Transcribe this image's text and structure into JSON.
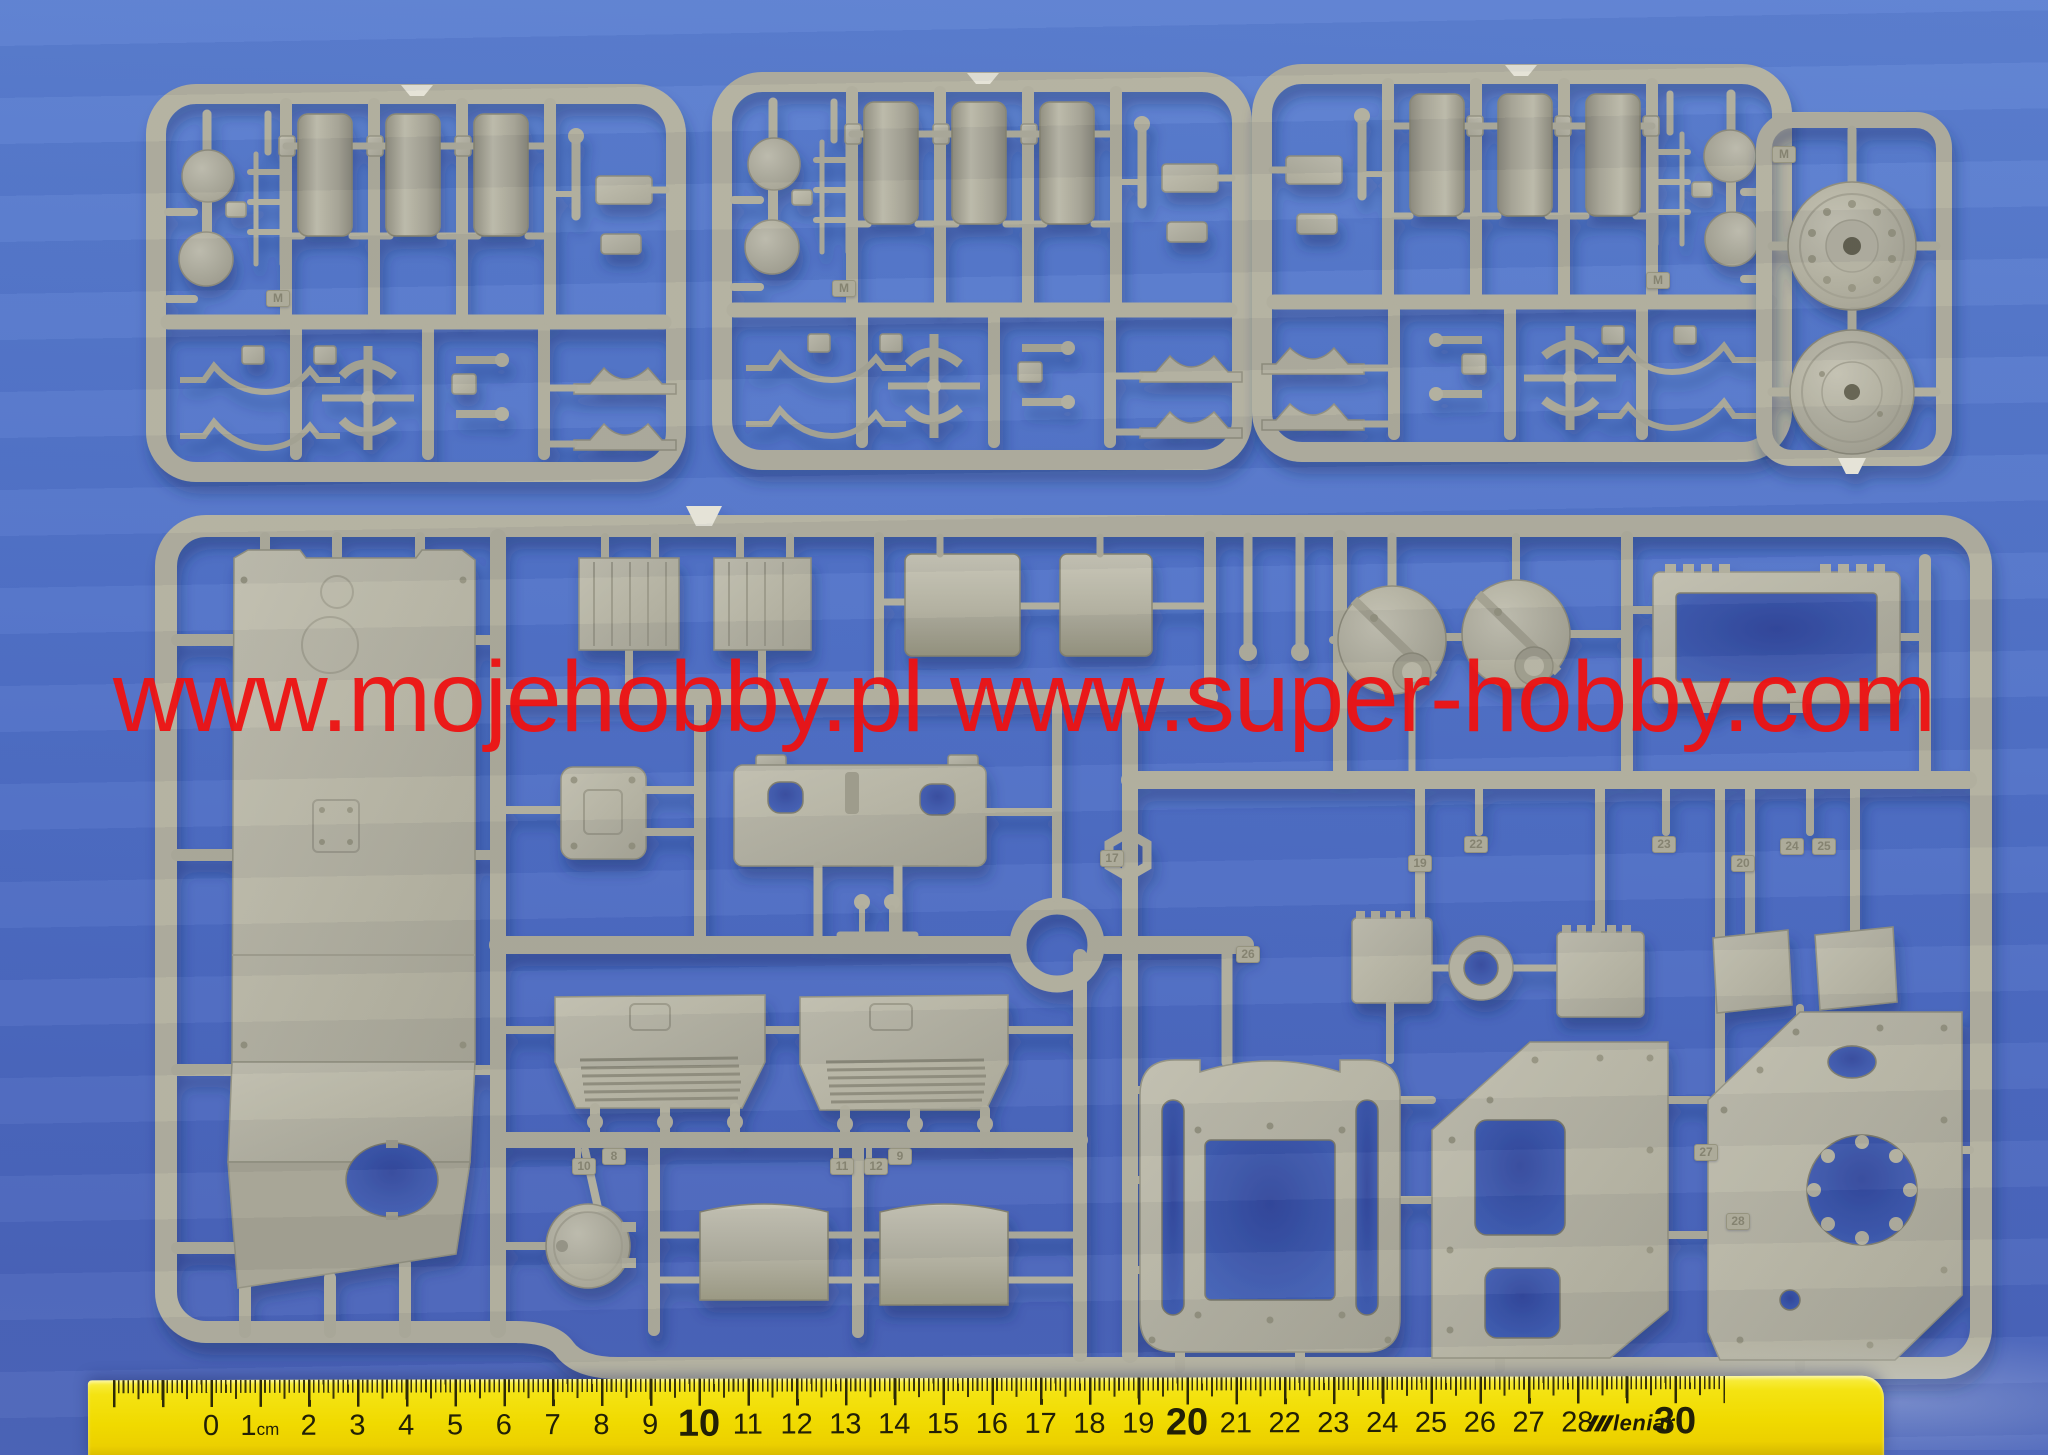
{
  "image": {
    "kind": "product photo",
    "subject": "Plastic model kit injection sprues (grey styrene) photographed on a blue background with a centimeter ruler"
  },
  "watermark": {
    "text": "www.mojehobby.pl www.super-hobby.com",
    "color": "#ee1212"
  },
  "ruler": {
    "brand": "leniar",
    "unit": "cm",
    "numbers": [
      {
        "cm": 0,
        "label": "0"
      },
      {
        "cm": 1,
        "label": "1",
        "suffix": "cm"
      },
      {
        "cm": 2,
        "label": "2"
      },
      {
        "cm": 3,
        "label": "3"
      },
      {
        "cm": 4,
        "label": "4"
      },
      {
        "cm": 5,
        "label": "5"
      },
      {
        "cm": 6,
        "label": "6"
      },
      {
        "cm": 7,
        "label": "7"
      },
      {
        "cm": 8,
        "label": "8"
      },
      {
        "cm": 9,
        "label": "9"
      },
      {
        "cm": 10,
        "label": "10",
        "big": true
      },
      {
        "cm": 11,
        "label": "11"
      },
      {
        "cm": 12,
        "label": "12"
      },
      {
        "cm": 13,
        "label": "13"
      },
      {
        "cm": 14,
        "label": "14"
      },
      {
        "cm": 15,
        "label": "15"
      },
      {
        "cm": 16,
        "label": "16"
      },
      {
        "cm": 17,
        "label": "17"
      },
      {
        "cm": 18,
        "label": "18"
      },
      {
        "cm": 19,
        "label": "19"
      },
      {
        "cm": 20,
        "label": "20",
        "big": true
      },
      {
        "cm": 21,
        "label": "21"
      },
      {
        "cm": 22,
        "label": "22"
      },
      {
        "cm": 23,
        "label": "23"
      },
      {
        "cm": 24,
        "label": "24"
      },
      {
        "cm": 25,
        "label": "25"
      },
      {
        "cm": 26,
        "label": "26"
      },
      {
        "cm": 27,
        "label": "27"
      },
      {
        "cm": 28,
        "label": "28"
      },
      {
        "cm": 30,
        "label": "30",
        "big": true
      }
    ]
  },
  "sprues": {
    "plastic_color": "#b4b2a2",
    "background_color": "#5172c8",
    "count": 5,
    "mold_letter_tabs": [
      {
        "label": "M",
        "x": 266,
        "y": 290
      },
      {
        "label": "M",
        "x": 832,
        "y": 280
      },
      {
        "label": "M",
        "x": 1646,
        "y": 272
      },
      {
        "label": "M",
        "x": 1772,
        "y": 146
      }
    ],
    "part_number_tabs": [
      {
        "label": "8",
        "x": 602,
        "y": 1148
      },
      {
        "label": "9",
        "x": 888,
        "y": 1148
      },
      {
        "label": "10",
        "x": 572,
        "y": 1158
      },
      {
        "label": "11",
        "x": 830,
        "y": 1158
      },
      {
        "label": "12",
        "x": 864,
        "y": 1158
      },
      {
        "label": "17",
        "x": 1100,
        "y": 850
      },
      {
        "label": "19",
        "x": 1408,
        "y": 855
      },
      {
        "label": "20",
        "x": 1731,
        "y": 855
      },
      {
        "label": "22",
        "x": 1464,
        "y": 836
      },
      {
        "label": "23",
        "x": 1652,
        "y": 836
      },
      {
        "label": "24",
        "x": 1780,
        "y": 838
      },
      {
        "label": "25",
        "x": 1812,
        "y": 838
      },
      {
        "label": "26",
        "x": 1236,
        "y": 946
      },
      {
        "label": "27",
        "x": 1694,
        "y": 1144
      },
      {
        "label": "28",
        "x": 1726,
        "y": 1213
      }
    ]
  }
}
